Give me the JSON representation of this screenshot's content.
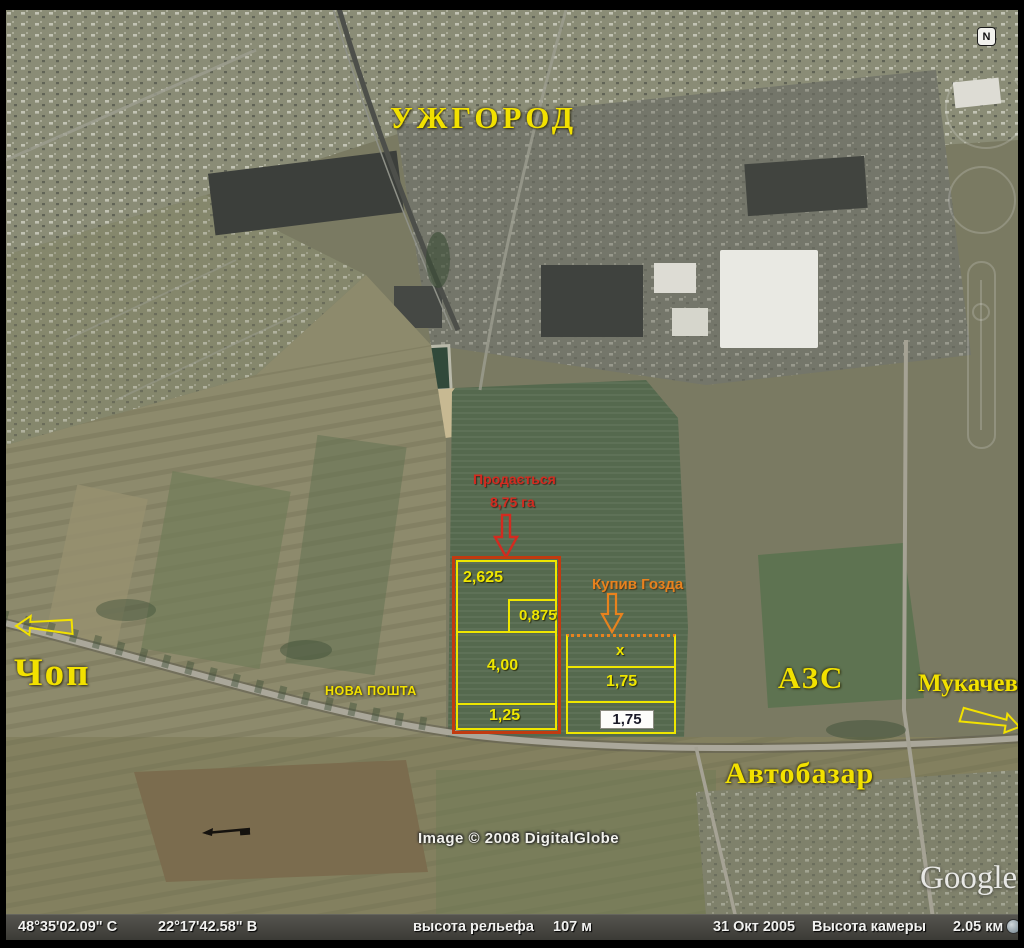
{
  "labels": {
    "uzhgorod": "УЖГОРОД",
    "chop": "Чоп",
    "mukachevo": "Мукачево",
    "azs": "АЗС",
    "avtobazar": "Автобазар",
    "nova_poshta": "НОВА ПОШТА"
  },
  "annotations": {
    "sale_line1": "Продається",
    "sale_line2": "8,75 га",
    "buyer": "Купив Гозда"
  },
  "parcels": {
    "left": {
      "a": "2,625",
      "b": "0,875",
      "c": "4,00",
      "d": "1,25"
    },
    "right": {
      "a": "x",
      "b": "1,75",
      "c_boxed": "1,75"
    }
  },
  "overlay": {
    "compass": "N",
    "copyright": "Image © 2008 DigitalGlobe",
    "watermark": "Google"
  },
  "status_bar": {
    "latitude": "48°35'02.09\" С",
    "longitude": "22°17'42.58\" В",
    "relief_label": "высота рельефа",
    "relief_value": "107 м",
    "date": "31 Окт 2005",
    "camera_label": "Высота камеры",
    "camera_value": "2.05 км"
  },
  "colors": {
    "label_yellow": "#f2e100",
    "annotation_red": "#d22b20",
    "annotation_orange": "#e8821e",
    "parcel_red_border": "#c23a10",
    "parcel_yellow_line": "#eee600",
    "field_green": "#55694e",
    "statusbar_bg": "#3a3a35"
  }
}
